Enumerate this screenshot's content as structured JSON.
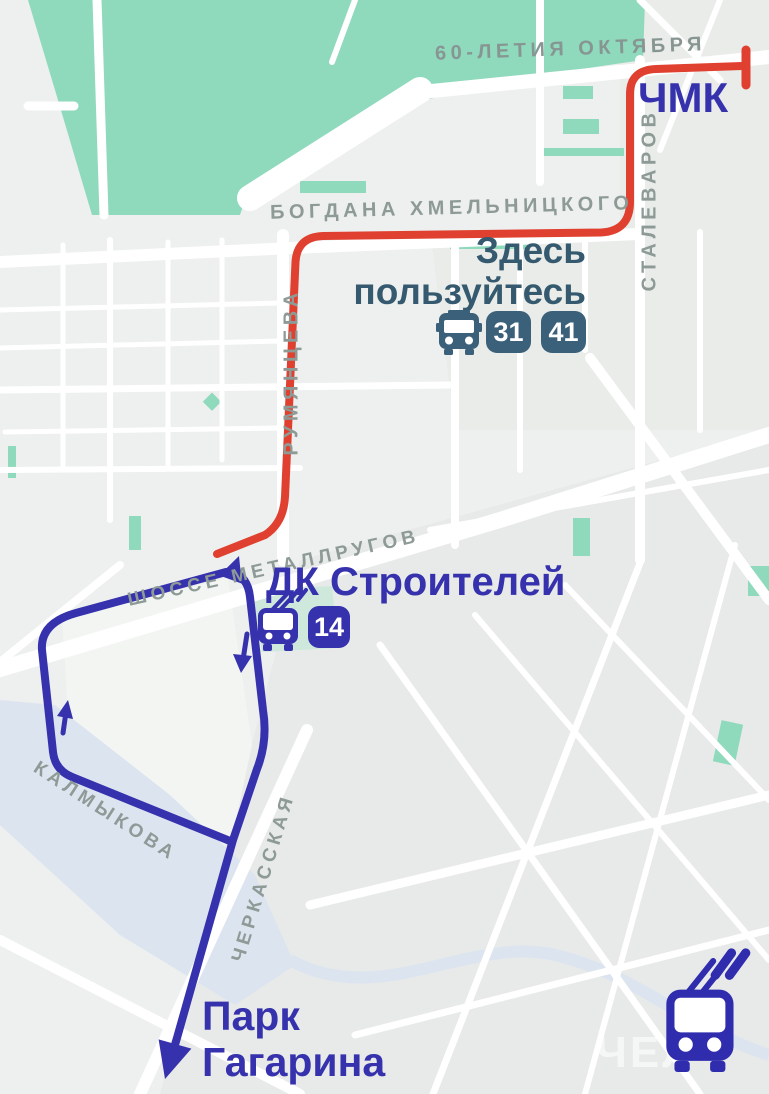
{
  "colors": {
    "background": "#edf0ee",
    "red_route": "#e0402f",
    "blue_route": "#3631ad",
    "indigo_text": "#3631ad",
    "slate_hint": "#35596e",
    "slate_badge": "#3a607a",
    "street_label": "#8d9a96",
    "park_green": "#8fd9bd",
    "water_blue": "#dce4f0"
  },
  "streets": {
    "oktyabrya": "60-ЛЕТИЯ ОКТЯБРЯ",
    "stalevarov": "СТАЛЕВАРОВ",
    "bogdana": "БОГДАНА ХМЕЛЬНИЦКОГО",
    "rumyantseva": "РУМЯНЦЕВА",
    "shosse": "ШОССЕ МЕТАЛЛРУГОВ",
    "kalmykova": "КАЛМЫКОВА",
    "cherkasskaya": "ЧЕРКАССКАЯ"
  },
  "stops": {
    "chmk": "ЧМК",
    "dk_stroiteley": "ДК Строителей",
    "park_line1": "Парк",
    "park_line2": "Гагарина"
  },
  "hint": {
    "line1": "Здесь",
    "line2": "пользуйтесь"
  },
  "bus_routes": [
    "31",
    "41"
  ],
  "trolleybus_route": "14",
  "watermark": "ЧЕЛ"
}
